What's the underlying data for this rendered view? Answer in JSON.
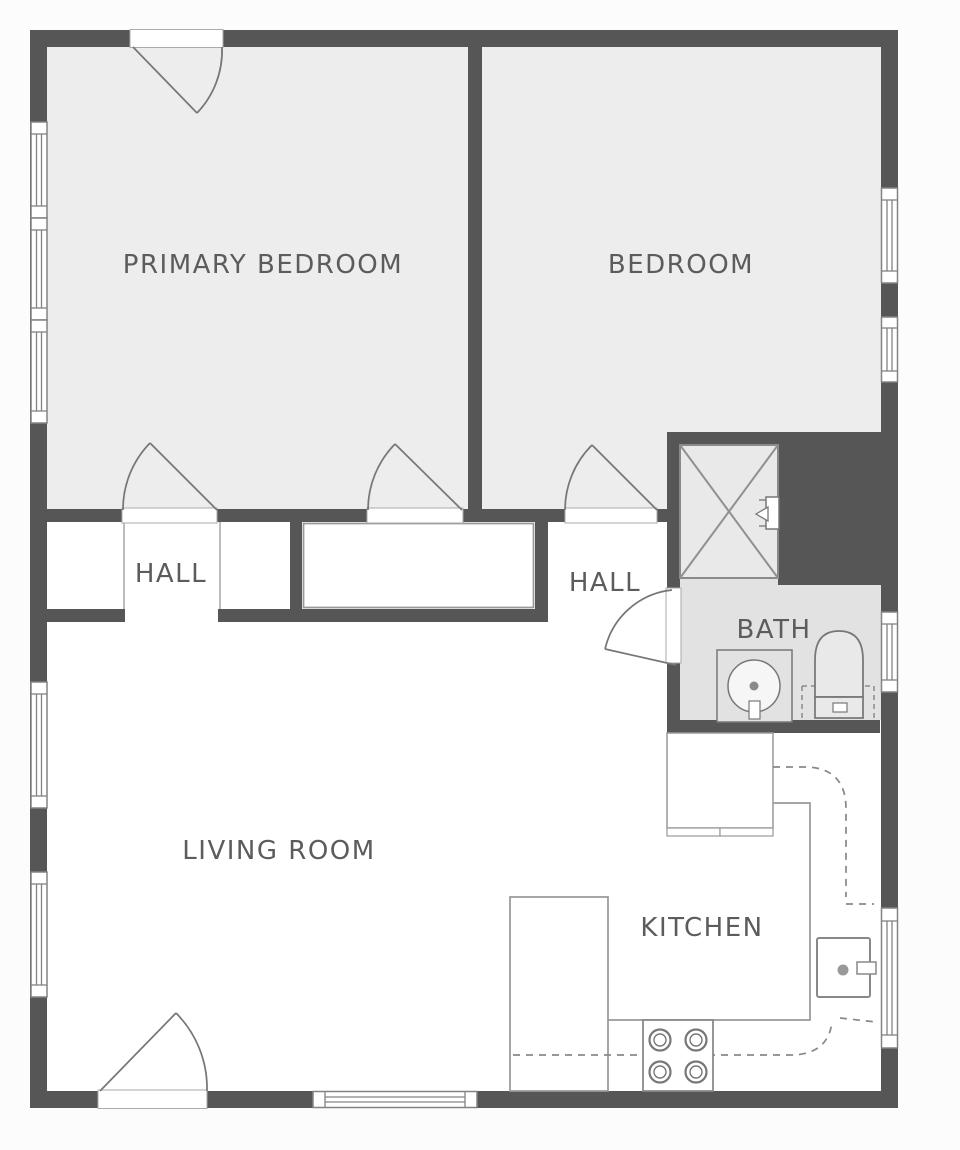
{
  "plan": {
    "type": "residential-floor-plan",
    "rooms": {
      "primary_bedroom": {
        "label": "PRIMARY BEDROOM"
      },
      "bedroom": {
        "label": "BEDROOM"
      },
      "hall_left": {
        "label": "HALL"
      },
      "hall_right": {
        "label": "HALL"
      },
      "bath": {
        "label": "BATH"
      },
      "living_room": {
        "label": "LIVING ROOM"
      },
      "kitchen": {
        "label": "KITCHEN"
      }
    },
    "fixtures": [
      "shower-with-x",
      "shower-valve",
      "bathroom-sink-vanity",
      "toilet-with-dashed-clearance",
      "kitchen-upper-cabinet",
      "kitchen-cabinet-doors",
      "left-counter-peninsula",
      "range-stove-4-burners",
      "wall-oven",
      "dashed-upper-cabinet-outline"
    ],
    "counts": {
      "windows": 10,
      "doors": 6,
      "closets": 3
    },
    "colors": {
      "wall": "#565656",
      "bedroom_floor": "#ededed",
      "bath_floor": "#e2e2e2",
      "shower_floor": "#e9e9e9",
      "room_white": "#ffffff",
      "line": "#8f8f8f",
      "text": "#5c5c5c",
      "page_background": "#fcfcfc"
    }
  }
}
